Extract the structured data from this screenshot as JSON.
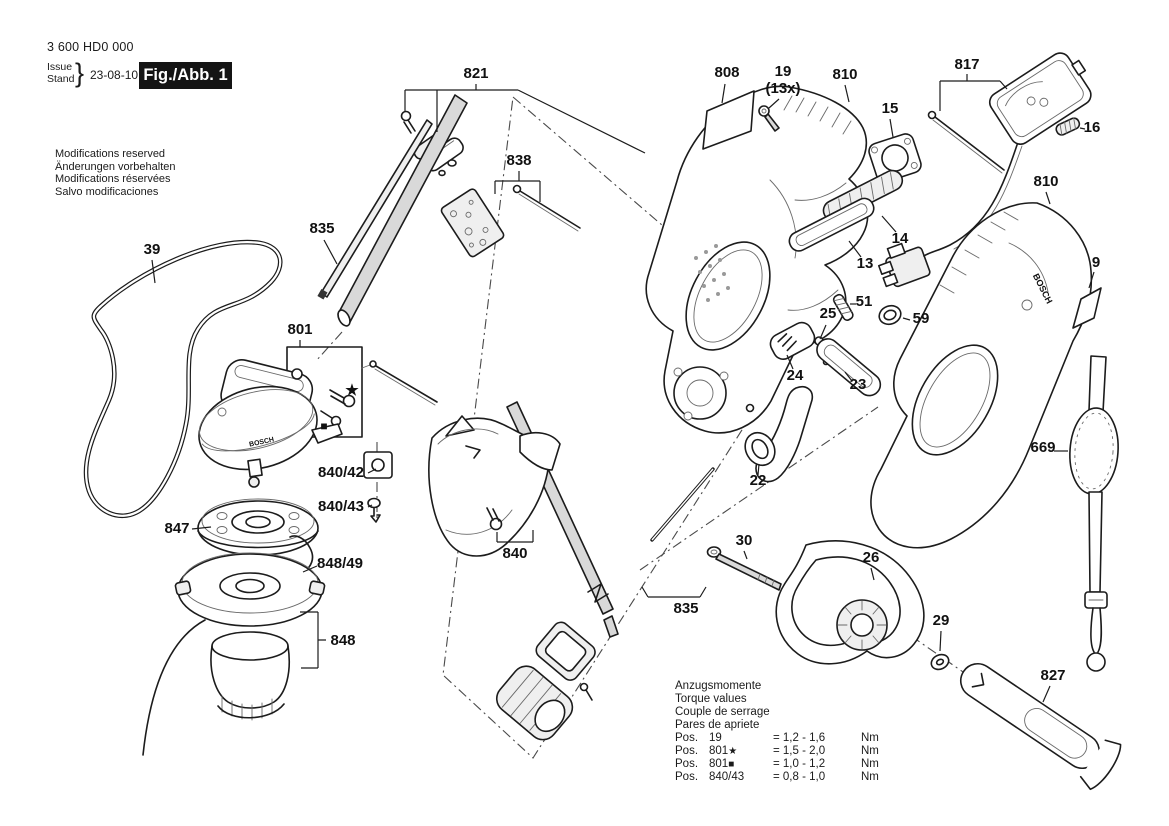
{
  "header": {
    "type_number": "3 600 HD0 000",
    "issue_label": "Issue",
    "stand_label": "Stand",
    "brace": "}",
    "date": "23-08-10",
    "figure_label": "Fig./Abb. 1"
  },
  "notices": [
    "Modifications reserved",
    "Änderungen vorbehalten",
    "Modifications réservées",
    "Salvo modificaciones"
  ],
  "torque": {
    "headings": [
      "Anzugsmomente",
      "Torque values",
      "Couple de serrage",
      "Pares de apriete"
    ],
    "rows": [
      {
        "pos_label": "Pos.",
        "pos": "19",
        "marker": "",
        "value": "= 1,2 - 1,6",
        "unit": "Nm"
      },
      {
        "pos_label": "Pos.",
        "pos": "801",
        "marker": "★",
        "value": "= 1,5 - 2,0",
        "unit": "Nm"
      },
      {
        "pos_label": "Pos.",
        "pos": "801",
        "marker": "■",
        "value": "= 1,0 - 1,2",
        "unit": "Nm"
      },
      {
        "pos_label": "Pos.",
        "pos": "840/43",
        "marker": "",
        "value": "= 0,8 - 1,0",
        "unit": "Nm"
      }
    ]
  },
  "diagram": {
    "part_labels": [
      {
        "id": "821",
        "text": "821",
        "x": 476,
        "y": 78
      },
      {
        "id": "808",
        "text": "808",
        "x": 727,
        "y": 77
      },
      {
        "id": "19",
        "text": "19",
        "x": 783,
        "y": 76
      },
      {
        "id": "19-qty",
        "text": "(13x)",
        "x": 783,
        "y": 93
      },
      {
        "id": "810-left",
        "text": "810",
        "x": 845,
        "y": 79
      },
      {
        "id": "817",
        "text": "817",
        "x": 967,
        "y": 69
      },
      {
        "id": "15",
        "text": "15",
        "x": 890,
        "y": 113
      },
      {
        "id": "16",
        "text": "16",
        "x": 1092,
        "y": 132
      },
      {
        "id": "810-right",
        "text": "810",
        "x": 1046,
        "y": 186
      },
      {
        "id": "838",
        "text": "838",
        "x": 519,
        "y": 165
      },
      {
        "id": "835-upper",
        "text": "835",
        "x": 322,
        "y": 233
      },
      {
        "id": "39",
        "text": "39",
        "x": 152,
        "y": 254
      },
      {
        "id": "801",
        "text": "801",
        "x": 300,
        "y": 334
      },
      {
        "id": "14",
        "text": "14",
        "x": 900,
        "y": 243
      },
      {
        "id": "13",
        "text": "13",
        "x": 865,
        "y": 268
      },
      {
        "id": "51",
        "text": "51",
        "x": 864,
        "y": 306
      },
      {
        "id": "25",
        "text": "25",
        "x": 828,
        "y": 318
      },
      {
        "id": "59",
        "text": "59",
        "x": 921,
        "y": 323
      },
      {
        "id": "24",
        "text": "24",
        "x": 795,
        "y": 380
      },
      {
        "id": "23",
        "text": "23",
        "x": 858,
        "y": 389
      },
      {
        "id": "22",
        "text": "22",
        "x": 758,
        "y": 485
      },
      {
        "id": "9",
        "text": "9",
        "x": 1096,
        "y": 267
      },
      {
        "id": "669",
        "text": "669",
        "x": 1043,
        "y": 452
      },
      {
        "id": "840/42",
        "text": "840/42",
        "x": 341,
        "y": 477
      },
      {
        "id": "840/43",
        "text": "840/43",
        "x": 341,
        "y": 511
      },
      {
        "id": "840",
        "text": "840",
        "x": 515,
        "y": 558
      },
      {
        "id": "847",
        "text": "847",
        "x": 177,
        "y": 533
      },
      {
        "id": "848/49",
        "text": "848/49",
        "x": 340,
        "y": 568
      },
      {
        "id": "848",
        "text": "848",
        "x": 343,
        "y": 645
      },
      {
        "id": "835-lower",
        "text": "835",
        "x": 686,
        "y": 613
      },
      {
        "id": "30",
        "text": "30",
        "x": 744,
        "y": 545
      },
      {
        "id": "26",
        "text": "26",
        "x": 871,
        "y": 562
      },
      {
        "id": "29",
        "text": "29",
        "x": 941,
        "y": 625
      },
      {
        "id": "827",
        "text": "827",
        "x": 1053,
        "y": 680
      },
      {
        "id": "star-marker",
        "text": "★",
        "x": 352,
        "y": 395,
        "size": 15
      },
      {
        "id": "square-marker",
        "text": "■",
        "x": 324,
        "y": 430,
        "size": 12
      },
      {
        "id": "brand-gearhead",
        "text": "BOSCH",
        "x": 262,
        "y": 444,
        "size": 7,
        "rotate": -12
      },
      {
        "id": "brand-housing",
        "text": "BOSCH",
        "x": 1040,
        "y": 290,
        "size": 9,
        "rotate": 63
      }
    ]
  }
}
